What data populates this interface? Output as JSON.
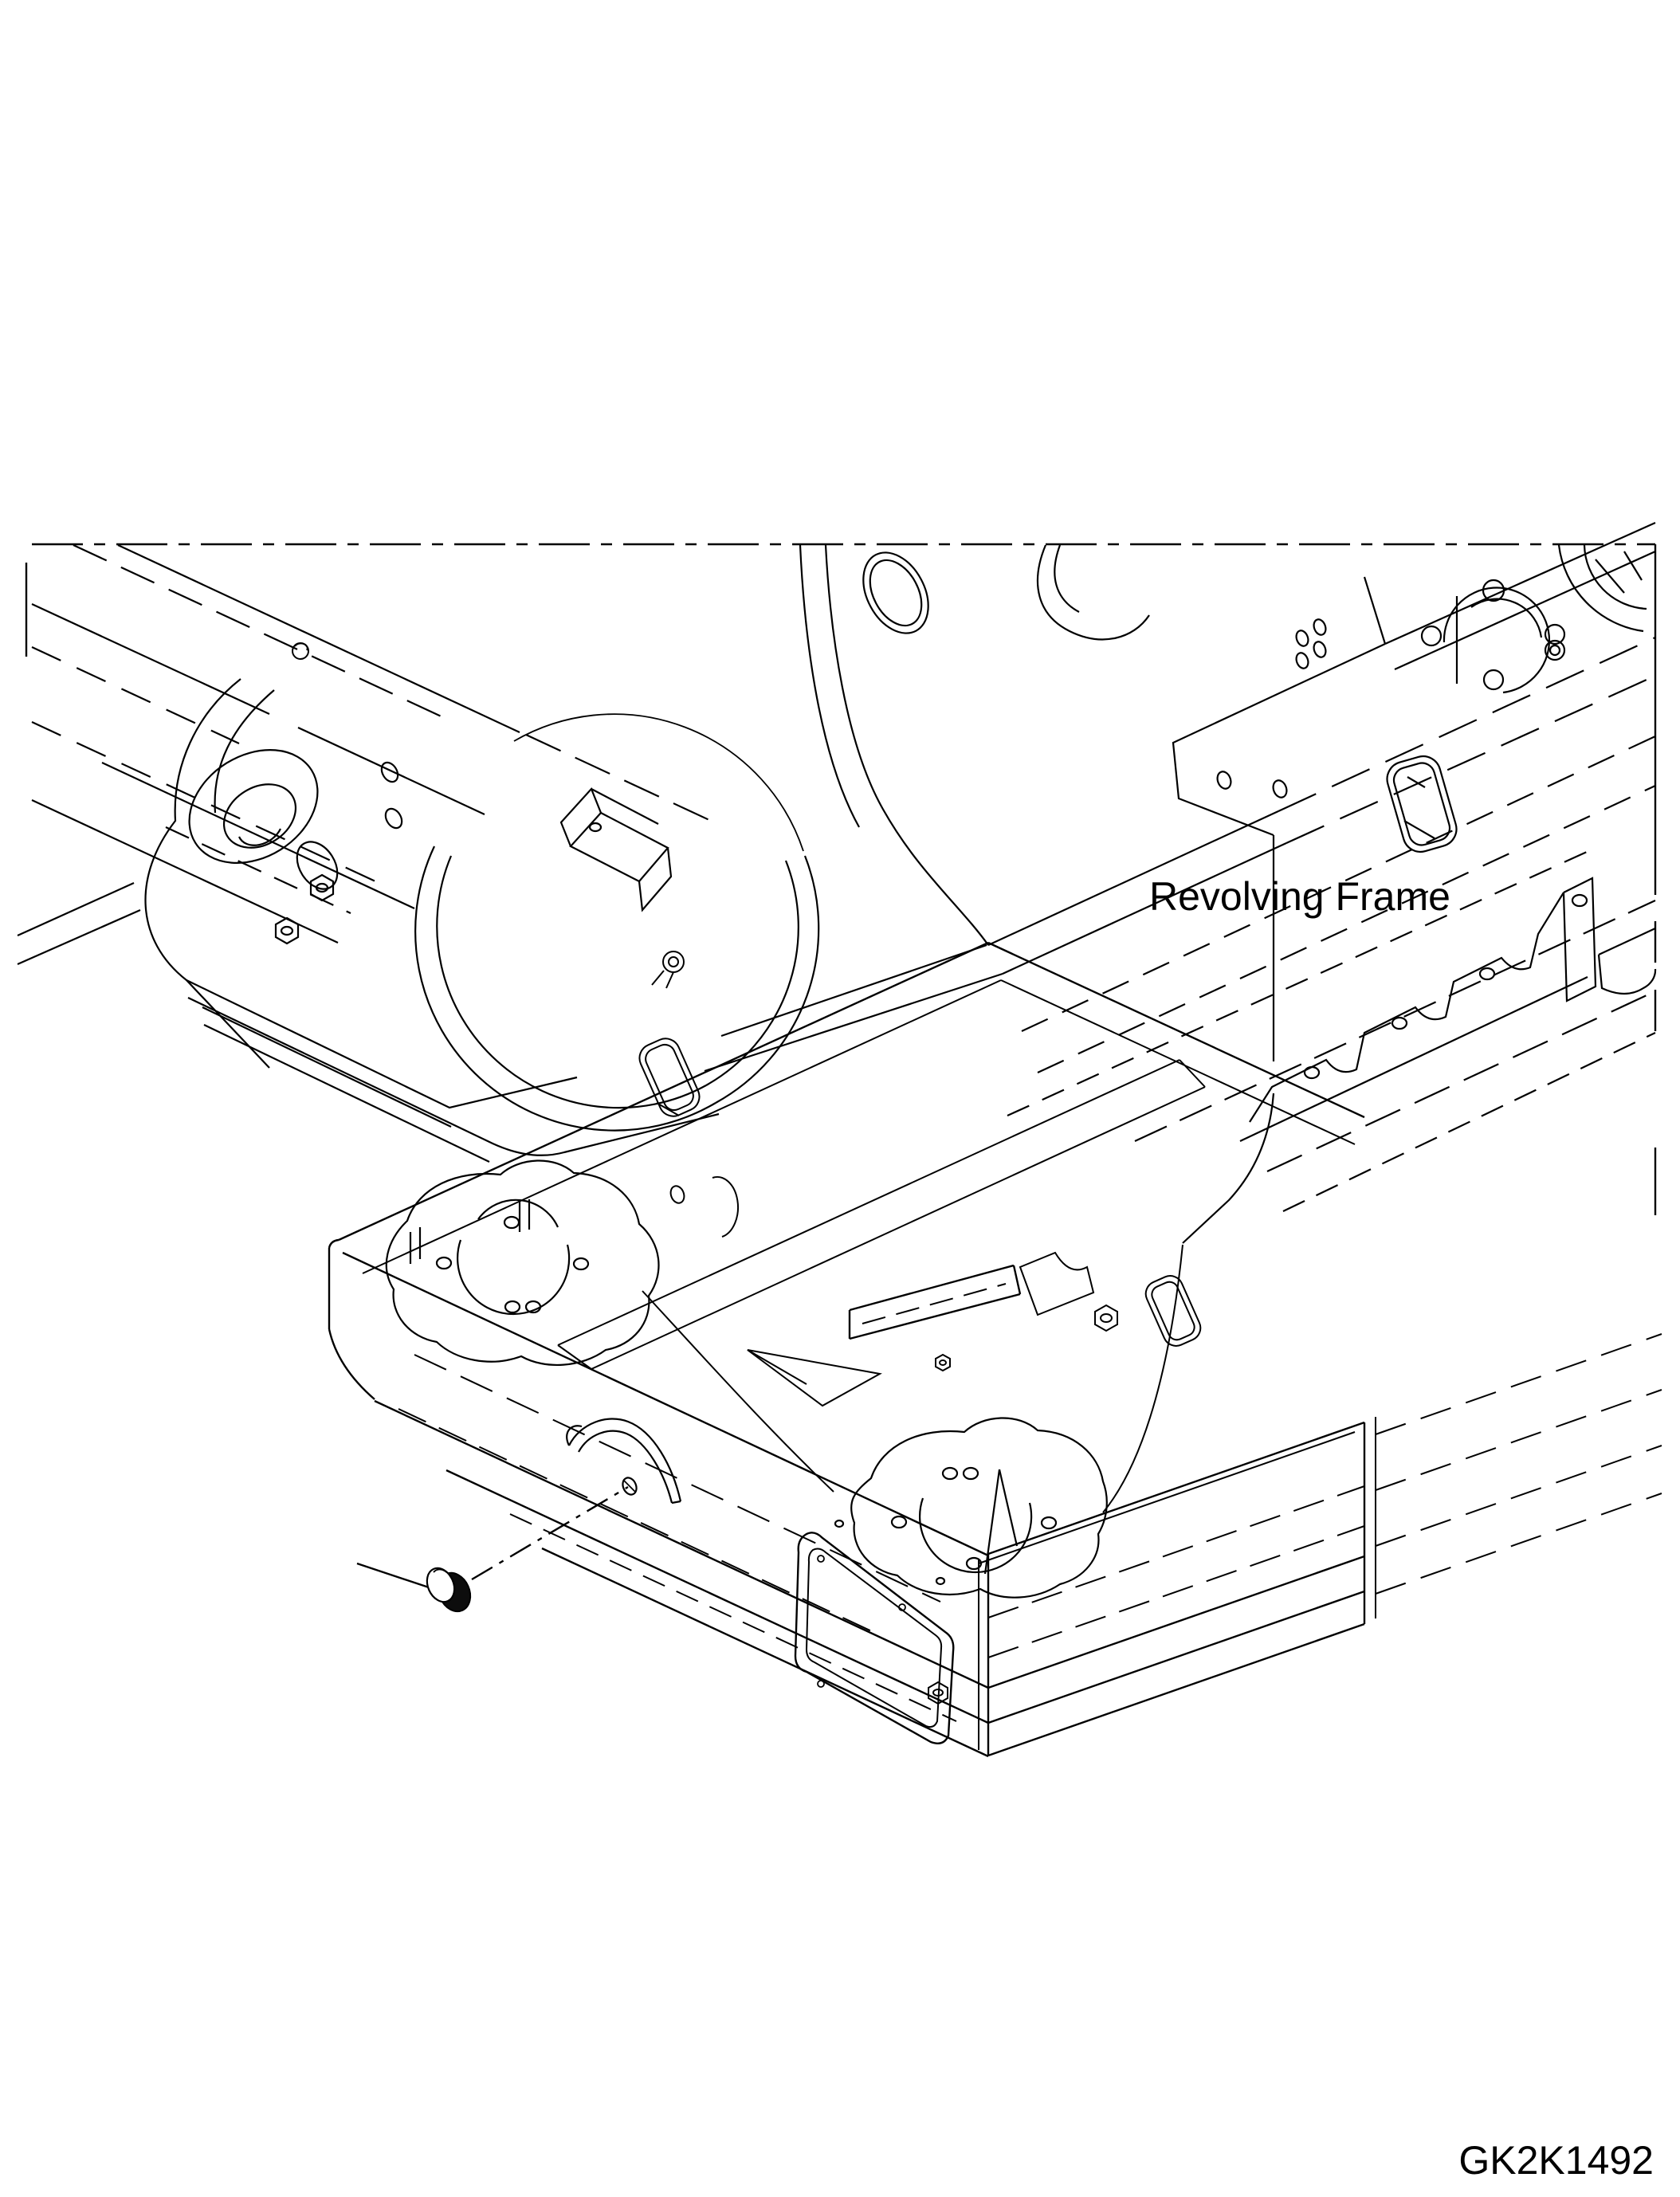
{
  "page": {
    "background": "#ffffff"
  },
  "diagram": {
    "type": "isometric-parts-drawing",
    "line_color": "#000000",
    "plug_fill": "#0d0d0d",
    "labels": {
      "frame_label": "Revolving Frame",
      "drawing_code": "GK2K1492"
    }
  }
}
